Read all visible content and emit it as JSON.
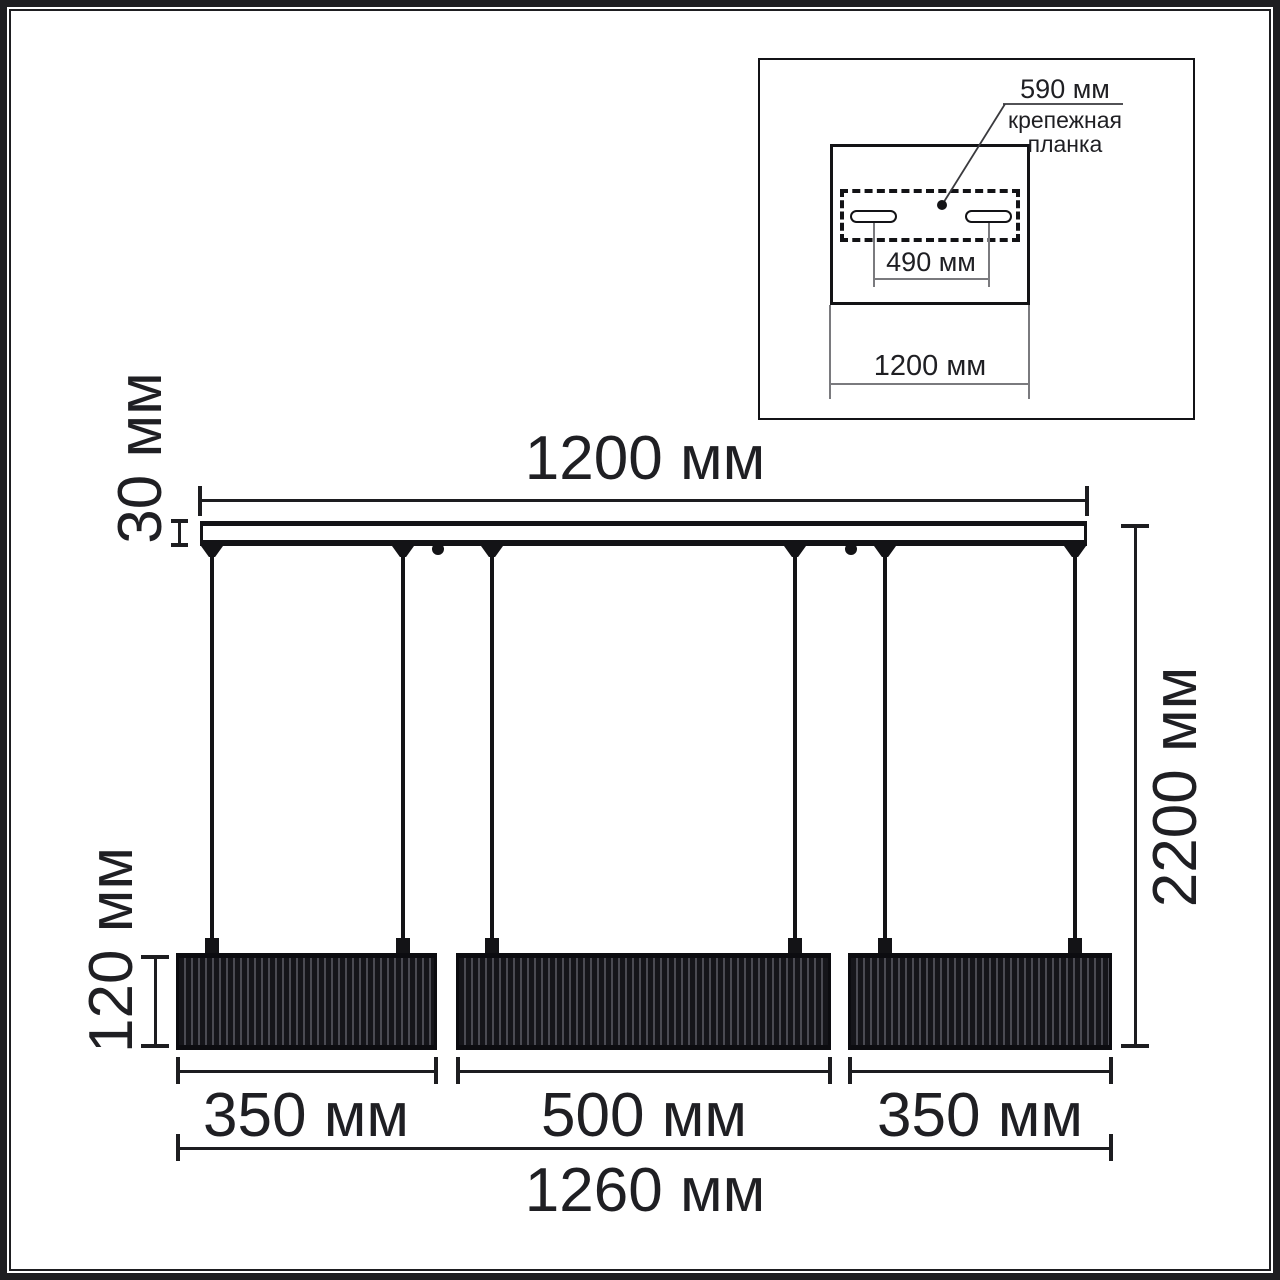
{
  "diagram_type": "pendant-light-dimension-drawing",
  "units": "мм",
  "colors": {
    "line": "#1d1d20",
    "text": "#1f1f23",
    "shade_dark": "#15151a",
    "shade_stripe": "#4a4a52",
    "background": "#ffffff"
  },
  "inset": {
    "plate_width_label": "590 мм",
    "plate_name": [
      "крепежная",
      "планка"
    ],
    "slot_spacing_label": "490 мм",
    "canopy_width_label": "1200 мм"
  },
  "main": {
    "bar_width_label": "1200 мм",
    "bar_thickness_label": "30 мм",
    "shade_height_label": "120 мм",
    "total_height_label": "2200 мм",
    "shade_width_labels": [
      "350 мм",
      "500 мм",
      "350 мм"
    ],
    "total_width_label": "1260 мм"
  }
}
